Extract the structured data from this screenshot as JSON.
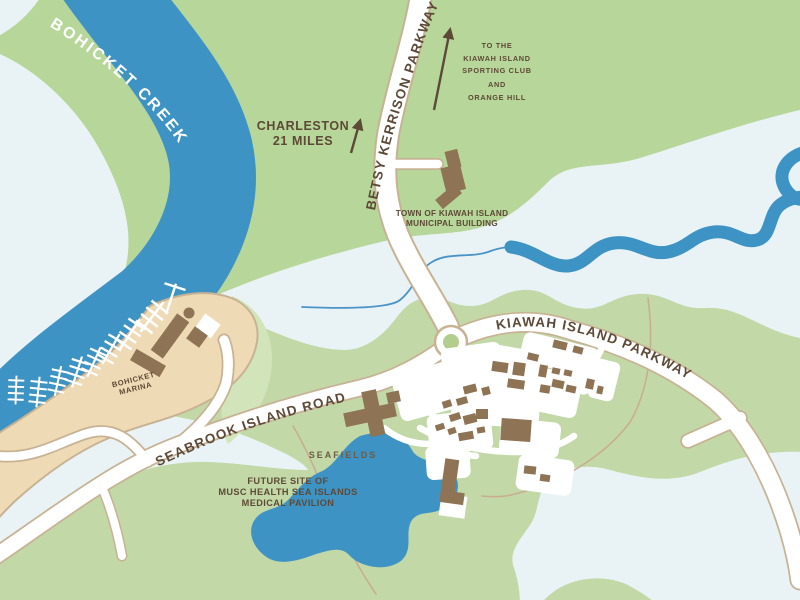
{
  "map": {
    "region_name": "Kiawah Island / Seabrook Island area map",
    "colors": {
      "land_green": "#b7d699",
      "land_green_south": "#c2d9a7",
      "land_green_light": "#d2e4ba",
      "marsh": "#e9f3f5",
      "water": "#3e93c5",
      "creek_line": "#4a94c8",
      "sand": "#eedab4",
      "road_edge": "#c8b294",
      "road_fill": "#ffffff",
      "building": "#8e7355",
      "roundabout_center": "#b3cd8e",
      "path_line": "#c9ad90",
      "label_brown": "#5d4937",
      "label_soft": "#6d5b46",
      "label_white": "#ffffff"
    },
    "labels": {
      "creek": "BOHICKET CREEK",
      "betsy_kerrison_parkway": "BETSY KERRISON PARKWAY",
      "kiawah_island_parkway": "KIAWAH ISLAND PARKWAY",
      "seabrook_island_road": "SEABROOK ISLAND ROAD",
      "bohicket_marina": [
        "BOHICKET",
        "MARINA"
      ],
      "municipal_building": [
        "TOWN OF KIAWAH ISLAND",
        "MUNICIPAL BUILDING"
      ],
      "seafields": "SEAFIELDS",
      "future_site": [
        "FUTURE SITE OF",
        "MUSC HEALTH SEA ISLANDS",
        "MEDICAL PAVILION"
      ],
      "charleston": [
        "CHARLESTON",
        "21 MILES"
      ],
      "sporting_club": [
        "TO THE",
        "KIAWAH ISLAND",
        "SPORTING CLUB",
        "AND",
        "ORANGE HILL"
      ]
    }
  }
}
